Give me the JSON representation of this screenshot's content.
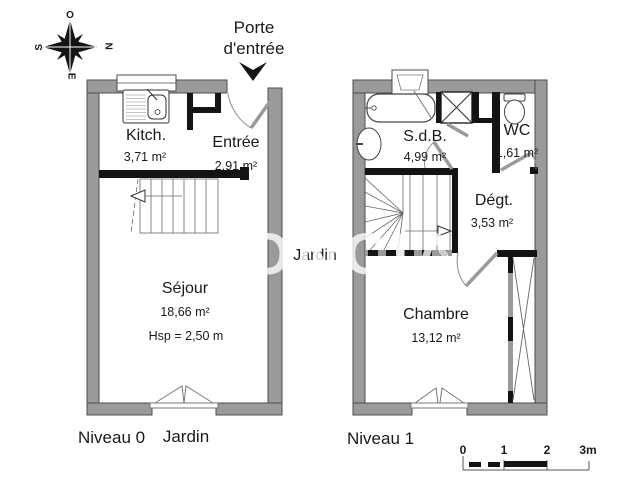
{
  "compass": {
    "top": "O",
    "right": "N",
    "left": "S",
    "bottom": "E"
  },
  "annotations": {
    "entrance_door": "Porte d'entrée",
    "garden_side": "Jardin",
    "garden_bottom": "Jardin"
  },
  "levels": [
    {
      "label": "Niveau 0",
      "rooms": [
        {
          "name": "Kitch.",
          "area": "3,71 m²"
        },
        {
          "name": "Entrée",
          "area": "2,91 m²"
        },
        {
          "name": "Séjour",
          "area": "18,66 m²",
          "ceiling": "Hsp = 2,50 m"
        }
      ]
    },
    {
      "label": "Niveau 1",
      "rooms": [
        {
          "name": "S.d.B.",
          "area": "4,99 m²"
        },
        {
          "name": "WC",
          "area": "1,61 m²"
        },
        {
          "name": "Dégt.",
          "area": "3,53 m²"
        },
        {
          "name": "Chambre",
          "area": "13,12 m²"
        }
      ]
    }
  ],
  "scale_bar": {
    "ticks": [
      "0",
      "1",
      "2",
      "3m"
    ]
  },
  "watermark": "FONCIA",
  "colors": {
    "wall": "#9a9a9a",
    "wall_outline": "#4d4d4d",
    "partition": "#141414",
    "text": "#1a1a1a"
  }
}
